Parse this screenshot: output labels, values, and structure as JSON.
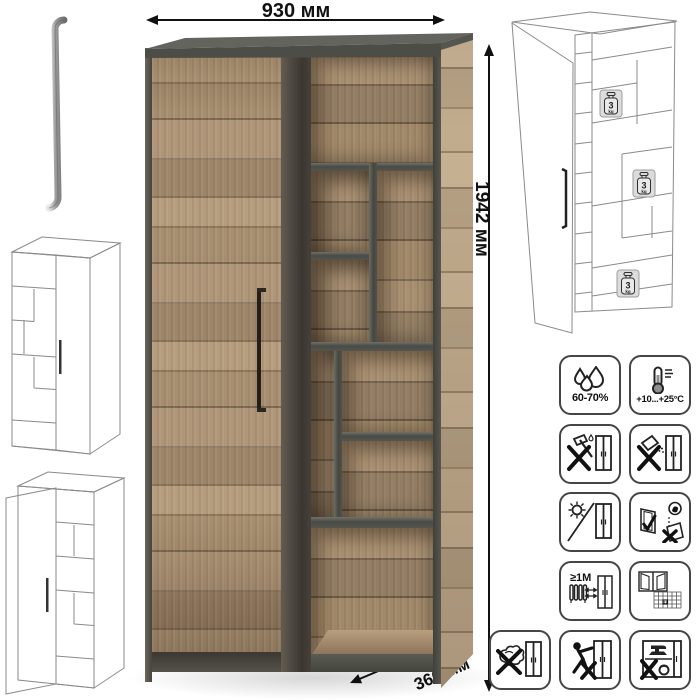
{
  "dimensions": {
    "width": "930 мм",
    "height": "1942 мм",
    "depth": "366 мм"
  },
  "shelf_load_badges": [
    {
      "value": "3",
      "unit": "kg"
    },
    {
      "value": "3",
      "unit": "kg"
    },
    {
      "value": "3",
      "unit": "kg"
    }
  ],
  "care_icons": {
    "humidity": {
      "icon": "humidity-drops-icon",
      "label": "60-70%"
    },
    "temperature": {
      "icon": "thermometer-icon",
      "label": "+10...+25°C"
    },
    "no_impact": {
      "icon": "no-impact-axe-icon"
    },
    "no_spill": {
      "icon": "no-spill-liquids-icon"
    },
    "no_sunlight": {
      "icon": "no-direct-sunlight-icon"
    },
    "assemble_upright": {
      "icon": "assemble-upright-icon"
    },
    "heat_distance": {
      "icon": "heat-source-distance-icon",
      "label": "≥1М"
    },
    "ventilation": {
      "icon": "ventilate-room-icon",
      "calendar_day": "21"
    },
    "no_wet_cleaning": {
      "icon": "no-wet-cleaning-icon"
    },
    "no_climbing": {
      "icon": "no-climbing-icon"
    },
    "no_overload": {
      "icon": "no-overload-icon"
    }
  },
  "colors": {
    "wood_mid": "#a48b6d",
    "wood_light": "#c0aa8d",
    "frame_dark": "#4c4d46",
    "line_art": "#2f2f2f",
    "arrow": "#111111"
  }
}
